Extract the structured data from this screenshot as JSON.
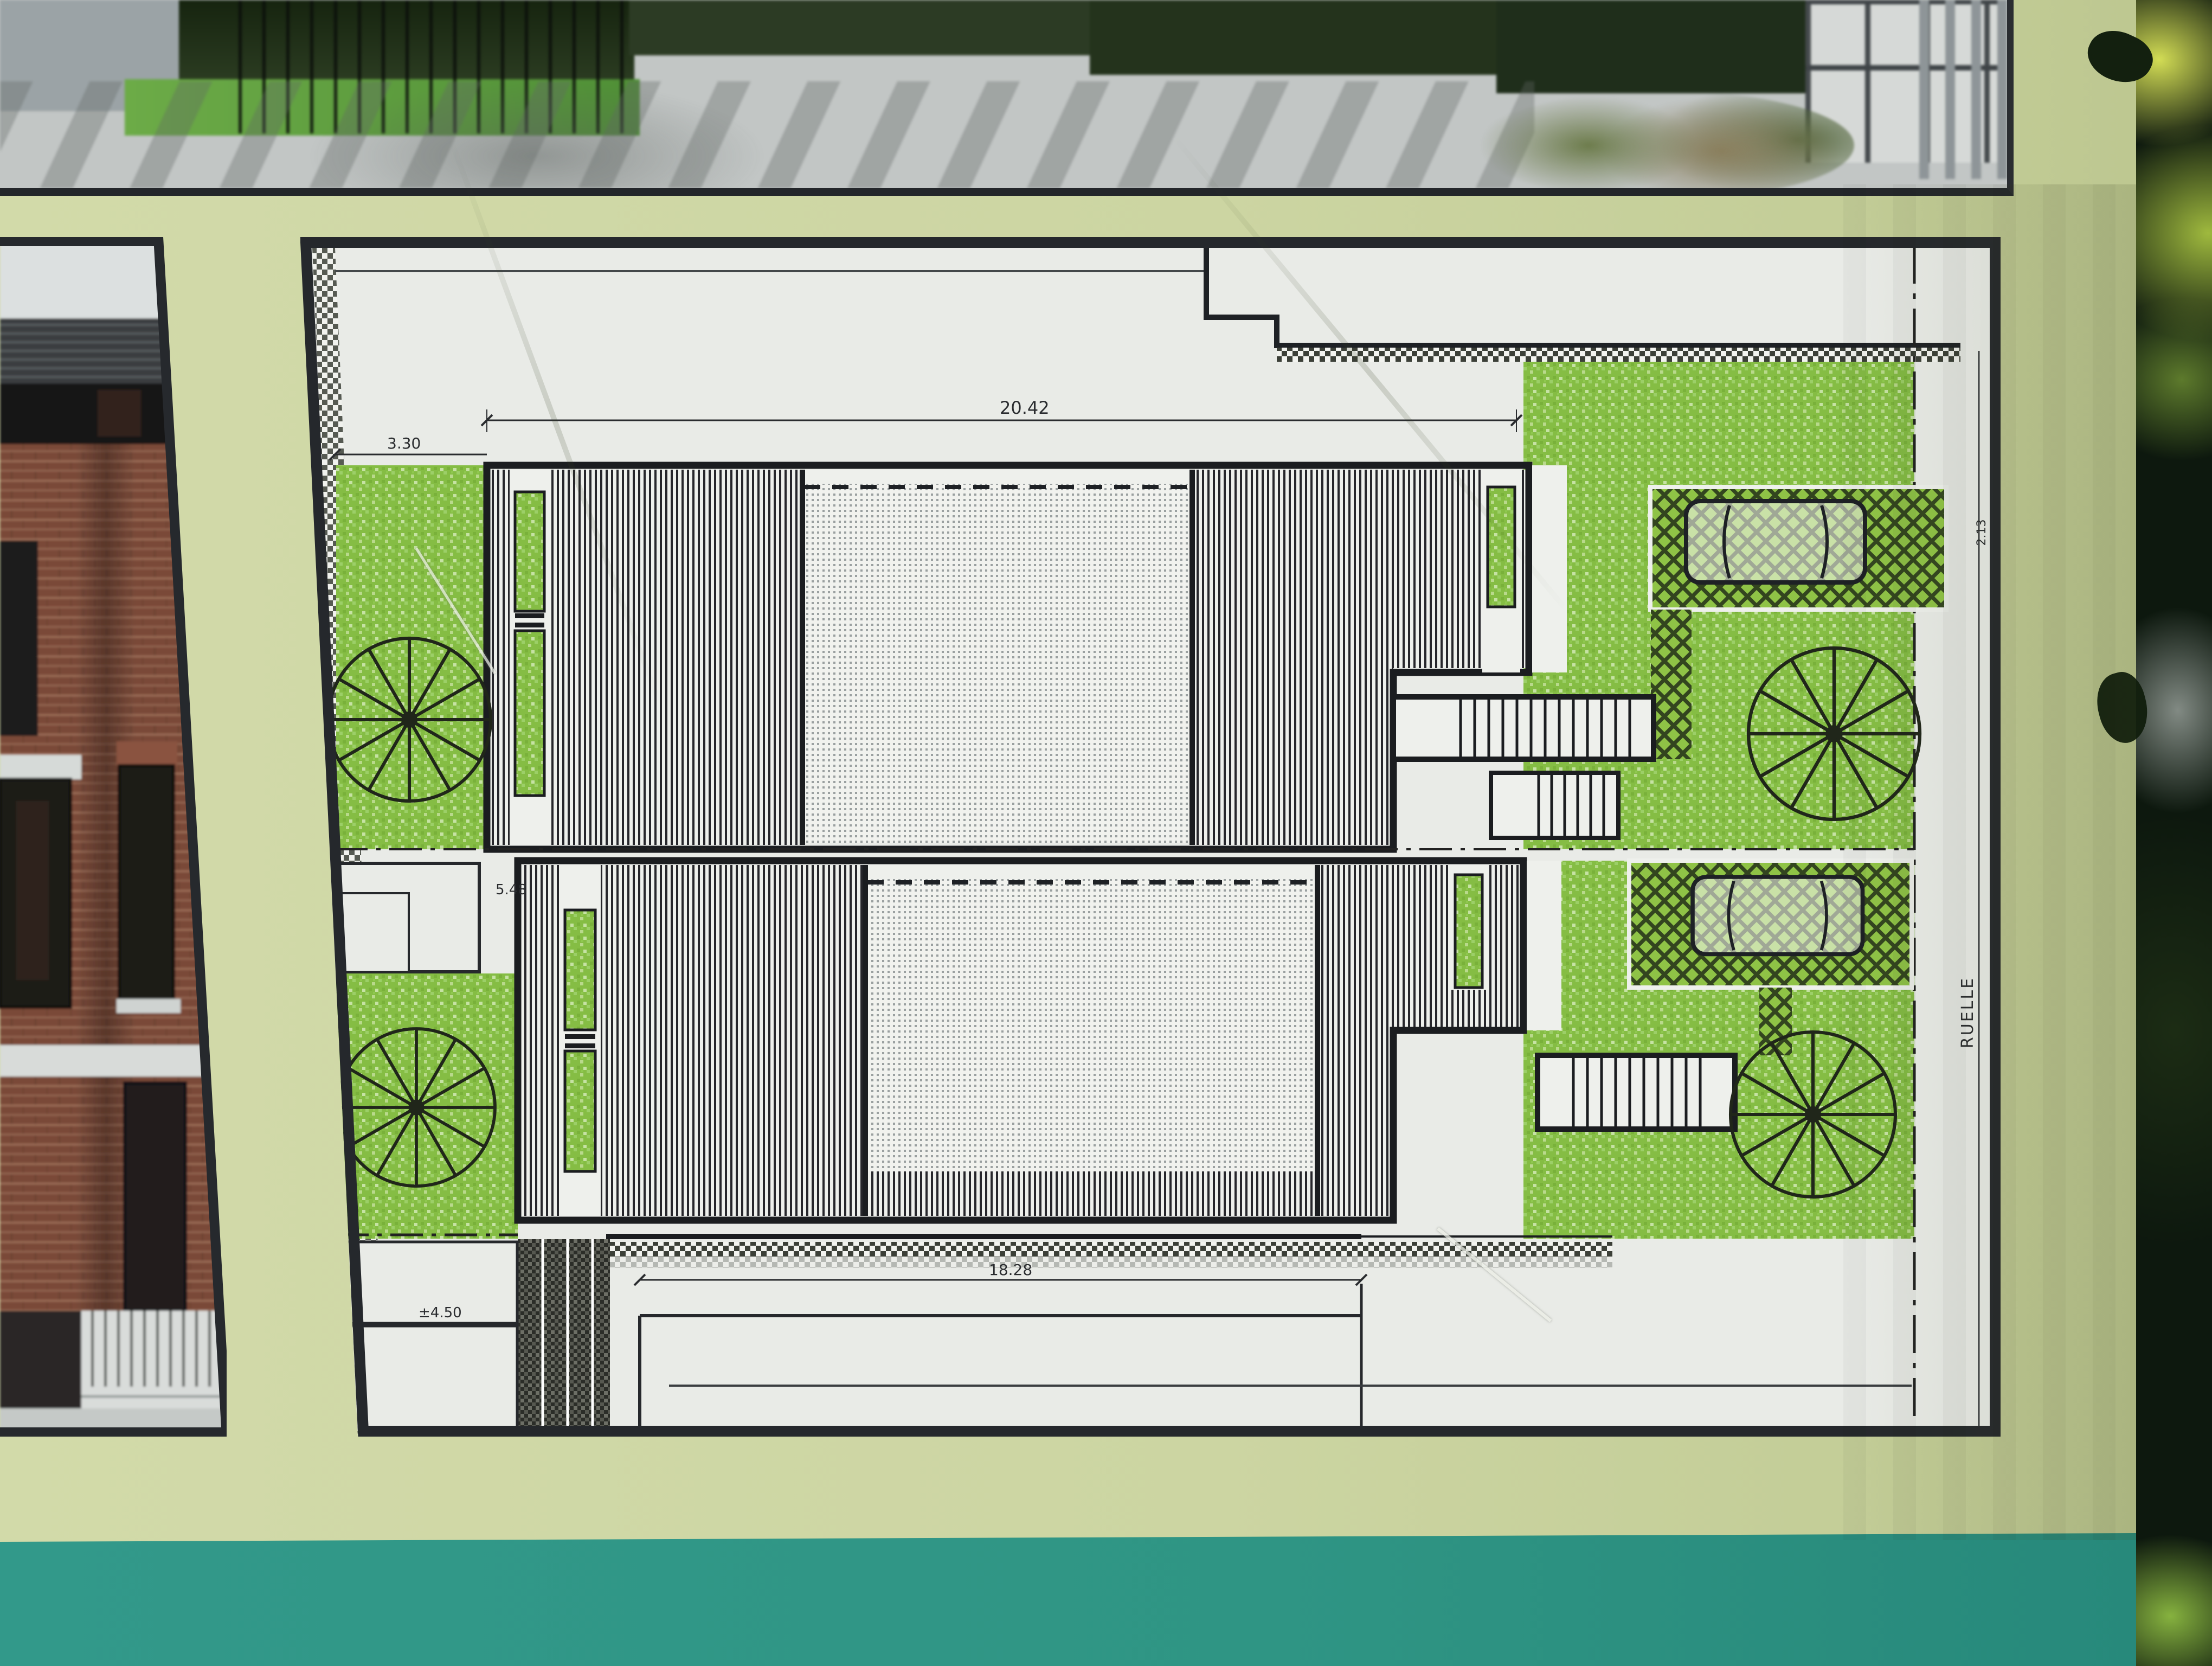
{
  "scene": "photo of a development sign board with an architectural site plan",
  "plan": {
    "dim_top": "20.42",
    "dim_left": "3.30",
    "dim_unit": "5.48",
    "dim_rear": "18.28",
    "level_rear": "±4.50",
    "dim_lane": "2.13",
    "lane_label": "RUELLE"
  },
  "palette": {
    "board": "#ccd5a2",
    "teal_band": "#2f9584",
    "plan_background": "#e9ebe7",
    "lawn_green": "#85bd44",
    "linework": "#1e2125",
    "brick": "#7a4a39",
    "foliage": "#0d180e"
  }
}
